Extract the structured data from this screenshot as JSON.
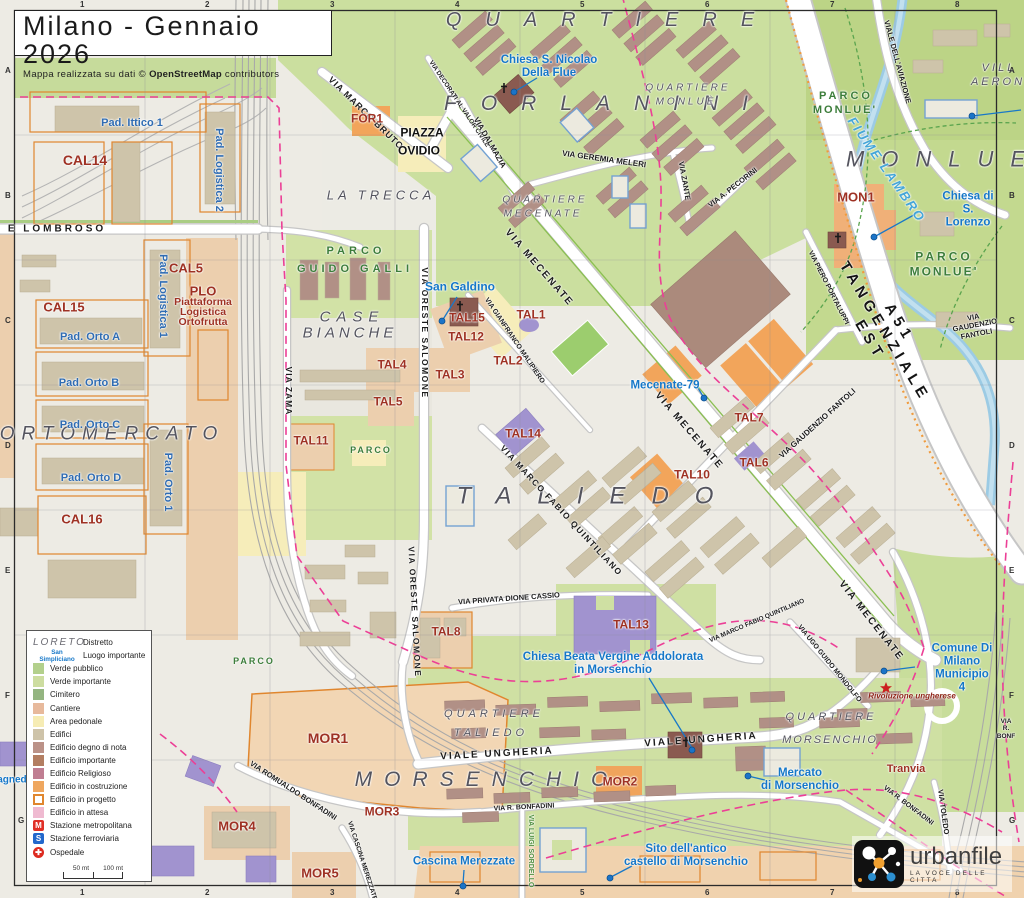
{
  "title": {
    "main": "Milano - Gennaio 2026",
    "sub_pre": "Mappa realizzata su dati © ",
    "sub_bold": "OpenStreetMap",
    "sub_post": " contributors"
  },
  "branding": {
    "name": "urbanfile",
    "tagline": "LA VOCE DELLE CITTA"
  },
  "grid": {
    "cols": [
      "1",
      "2",
      "3",
      "4",
      "5",
      "6",
      "7",
      "8"
    ],
    "rows": [
      "A",
      "B",
      "C",
      "D",
      "E",
      "F",
      "G"
    ]
  },
  "legend": {
    "rows": [
      {
        "type": "sample-district",
        "sample": "LORETO",
        "label": "Distretto"
      },
      {
        "type": "sample-place",
        "sample": "San Simpliciano",
        "label": "Luogo importante"
      },
      {
        "type": "fill",
        "color": "#b3d08c",
        "label": "Verde pubblico"
      },
      {
        "type": "fill",
        "color": "#cddda0",
        "label": "Verde importante"
      },
      {
        "type": "fill",
        "color": "#94b581",
        "label": "Cimitero"
      },
      {
        "type": "fill",
        "color": "#e7b99c",
        "label": "Cantiere"
      },
      {
        "type": "fill",
        "color": "#f6ecb4",
        "label": "Area pedonale"
      },
      {
        "type": "fill",
        "color": "#cec3a9",
        "label": "Edifici"
      },
      {
        "type": "fill",
        "color": "#bb9288",
        "label": "Edificio degno di nota"
      },
      {
        "type": "fill",
        "color": "#b37e62",
        "label": "Edificio importante"
      },
      {
        "type": "fill",
        "color": "#c07e92",
        "label": "Edificio Religioso"
      },
      {
        "type": "fill",
        "color": "#efa75f",
        "label": "Edificio in costruzione"
      },
      {
        "type": "outline",
        "color": "#e0862e",
        "label": "Edificio in progetto"
      },
      {
        "type": "fill",
        "color": "#efbad1",
        "label": "Edificio in attesa"
      },
      {
        "type": "badge",
        "symbol": "M",
        "bg": "#e02f26",
        "label": "Stazione metropolitana"
      },
      {
        "type": "badge",
        "symbol": "S",
        "bg": "#2268cc",
        "label": "Stazione ferroviaria"
      },
      {
        "type": "hospital",
        "symbol": "✚",
        "bg": "#dd2b20",
        "label": "Ospedale"
      }
    ],
    "scale": {
      "half": "50 mt",
      "full": "100 mt"
    }
  },
  "map_labels": [
    {
      "t": "QUARTIERE",
      "x": 612,
      "y": 20,
      "c": "dist",
      "s": 20,
      "ls": 24
    },
    {
      "t": "FORLANINI",
      "x": 608,
      "y": 104,
      "c": "dist",
      "s": 21,
      "ls": 24
    },
    {
      "t": "MONLUE",
      "x": 944,
      "y": 160,
      "c": "dist",
      "s": 22,
      "ls": 17
    },
    {
      "t": "ORTOMERCATO",
      "x": 112,
      "y": 434,
      "c": "dist",
      "s": 19,
      "ls": 7
    },
    {
      "t": "CASE",
      "x": 352,
      "y": 318,
      "c": "dist",
      "s": 15,
      "ls": 6
    },
    {
      "t": "BIANCHE",
      "x": 350,
      "y": 334,
      "c": "dist",
      "s": 15,
      "ls": 4
    },
    {
      "t": "TALIEDO",
      "x": 598,
      "y": 497,
      "c": "dist",
      "s": 24,
      "ls": 26
    },
    {
      "t": "MORSENCHIO",
      "x": 487,
      "y": 780,
      "c": "dist",
      "s": 21,
      "ls": 12
    },
    {
      "t": "LA TRECCA",
      "x": 381,
      "y": 196,
      "c": "dist",
      "s": 13,
      "ls": 4
    },
    {
      "t": "QUARTIERE",
      "x": 545,
      "y": 200,
      "c": "dist",
      "s": 10,
      "ls": 3
    },
    {
      "t": "MECENATE",
      "x": 543,
      "y": 214,
      "c": "dist",
      "s": 10,
      "ls": 3
    },
    {
      "t": "QUARTIERE",
      "x": 688,
      "y": 88,
      "c": "dist",
      "s": 10,
      "ls": 3
    },
    {
      "t": "MONLUÈ",
      "x": 686,
      "y": 102,
      "c": "dist",
      "s": 10,
      "ls": 3
    },
    {
      "t": "QUARTIERE",
      "x": 494,
      "y": 714,
      "c": "dist",
      "s": 11,
      "ls": 4
    },
    {
      "t": "TALIEDO",
      "x": 491,
      "y": 733,
      "c": "dist",
      "s": 11,
      "ls": 4
    },
    {
      "t": "QUARTIERE",
      "x": 831,
      "y": 717,
      "c": "dist",
      "s": 11,
      "ls": 3
    },
    {
      "t": "MORSENCHIO",
      "x": 830,
      "y": 740,
      "c": "dist",
      "s": 11,
      "ls": 2
    },
    {
      "t": "VILL",
      "x": 999,
      "y": 68,
      "c": "dist",
      "s": 11,
      "ls": 3
    },
    {
      "t": "AERON",
      "x": 998,
      "y": 82,
      "c": "dist",
      "s": 11,
      "ls": 3
    },
    {
      "t": "PARCO",
      "x": 356,
      "y": 251,
      "c": "park",
      "s": 11,
      "ls": 4
    },
    {
      "t": "GUIDO GALLI",
      "x": 355,
      "y": 269,
      "c": "park",
      "s": 11,
      "ls": 4
    },
    {
      "t": "PARCO",
      "x": 846,
      "y": 96,
      "c": "park",
      "s": 11,
      "ls": 3
    },
    {
      "t": "MONLUE'",
      "x": 845,
      "y": 110,
      "c": "park",
      "s": 11,
      "ls": 2
    },
    {
      "t": "PARCO",
      "x": 944,
      "y": 257,
      "c": "park",
      "s": 12,
      "ls": 3
    },
    {
      "t": "MONLUE'",
      "x": 944,
      "y": 272,
      "c": "park",
      "s": 12,
      "ls": 2
    },
    {
      "t": "PARCO",
      "x": 371,
      "y": 450,
      "c": "park",
      "s": 9,
      "ls": 2
    },
    {
      "t": "PARCO",
      "x": 254,
      "y": 661,
      "c": "park",
      "s": 9,
      "ls": 2
    },
    {
      "t": "FIUME LAMBRO",
      "x": 886,
      "y": 170,
      "r": 55,
      "c": "river",
      "s": 13,
      "ls": 2
    },
    {
      "t": "A51  TANGENZIALE  EST",
      "x": 884,
      "y": 332,
      "r": 59,
      "c": "hwy",
      "s": 15,
      "ls": 5
    },
    {
      "t": "VIA MARCO BRUTO",
      "x": 366,
      "y": 113,
      "r": 44,
      "c": "street",
      "s": 9,
      "ls": 1
    },
    {
      "t": "VIA DECORATI AL VALOR CIVILE",
      "x": 459,
      "y": 104,
      "r": 56,
      "c": "street",
      "s": 6.5
    },
    {
      "t": "VIA DALMAZIA",
      "x": 489,
      "y": 143,
      "r": 60,
      "c": "street",
      "s": 8
    },
    {
      "t": "VIA GEREMIA MELERI",
      "x": 604,
      "y": 160,
      "r": 8,
      "c": "street",
      "s": 8
    },
    {
      "t": "VIA ZANTE",
      "x": 684,
      "y": 181,
      "r": 80,
      "c": "street",
      "s": 7.5
    },
    {
      "t": "VIA A. PECORINI",
      "x": 733,
      "y": 188,
      "r": -38,
      "c": "street",
      "s": 7.5
    },
    {
      "t": "VIALE DELL'AVIAZIONE",
      "x": 897,
      "y": 62,
      "r": 75,
      "c": "street",
      "s": 7.5
    },
    {
      "t": "VIA  MECENATE",
      "x": 539,
      "y": 268,
      "r": 49,
      "c": "street",
      "s": 10,
      "ls": 2
    },
    {
      "t": "VIA  MECENATE",
      "x": 689,
      "y": 431,
      "r": 49,
      "c": "street",
      "s": 10,
      "ls": 2
    },
    {
      "t": "VIA  MECENATE",
      "x": 871,
      "y": 621,
      "r": 52,
      "c": "street",
      "s": 10,
      "ls": 2
    },
    {
      "t": "VIA ORESTE SALOMONE",
      "x": 424,
      "y": 333,
      "r": 90,
      "c": "street",
      "s": 8.5,
      "ls": 1.5
    },
    {
      "t": "VIA ORESTE SALOMONE",
      "x": 414,
      "y": 612,
      "r": 87,
      "c": "street",
      "s": 8.5,
      "ls": 1.5
    },
    {
      "t": "VIA ZAMA",
      "x": 288,
      "y": 391,
      "r": 90,
      "c": "street",
      "s": 8.5,
      "ls": 1
    },
    {
      "t": "VIA GIANFRANCO MALIPIERO",
      "x": 514,
      "y": 341,
      "r": 56,
      "c": "street",
      "s": 7
    },
    {
      "t": "VIA MARCO FABIO QUINTILIANO",
      "x": 561,
      "y": 511,
      "r": 47,
      "c": "street",
      "s": 8.5,
      "ls": 1.5
    },
    {
      "t": "VIA MARCO FABIO QUINTILIANO",
      "x": 757,
      "y": 621,
      "r": -23,
      "c": "street",
      "s": 6.5
    },
    {
      "t": "VIA PRIVATA DIONE CASSIO",
      "x": 509,
      "y": 599,
      "r": -4,
      "c": "street",
      "s": 7.5
    },
    {
      "t": "VIA GAUDENZIO FANTOLI",
      "x": 818,
      "y": 424,
      "r": -42,
      "c": "street",
      "s": 8
    },
    {
      "t": "VIA GAUDENZIO FANTOLI",
      "x": 975,
      "y": 326,
      "r": -11,
      "c": "street",
      "s": 7.5
    },
    {
      "t": "VIA PIERO PORTALUPPI",
      "x": 828,
      "y": 288,
      "r": 63,
      "c": "street",
      "s": 7
    },
    {
      "t": "VIA UGO GUIDO MONDOLFO",
      "x": 829,
      "y": 664,
      "r": 51,
      "c": "street",
      "s": 7
    },
    {
      "t": "E  LOMBROSO",
      "x": 57,
      "y": 229,
      "c": "street",
      "s": 10,
      "ls": 3
    },
    {
      "t": "VIALE  UNGHERIA",
      "x": 497,
      "y": 754,
      "r": -3,
      "c": "street",
      "s": 10,
      "ls": 2
    },
    {
      "t": "VIALE  UNGHERIA",
      "x": 701,
      "y": 740,
      "r": -4,
      "c": "street",
      "s": 10,
      "ls": 2
    },
    {
      "t": "VIA ROMUALDO BONFADINI",
      "x": 293,
      "y": 791,
      "r": 33,
      "c": "street",
      "s": 7.5
    },
    {
      "t": "VIA R. BONFADINI",
      "x": 524,
      "y": 808,
      "r": -3,
      "c": "street",
      "s": 7
    },
    {
      "t": "VIA R. BONFADINI",
      "x": 908,
      "y": 806,
      "r": 37,
      "c": "street",
      "s": 7
    },
    {
      "t": "VIA R. BONF",
      "x": 1006,
      "y": 729,
      "c": "street",
      "s": 6.5
    },
    {
      "t": "VIA TOLEDO",
      "x": 943,
      "y": 812,
      "r": 82,
      "c": "street",
      "s": 7.5
    },
    {
      "t": "VIA CASCINA MEREZZATE",
      "x": 362,
      "y": 861,
      "r": 72,
      "c": "street",
      "s": 6.5
    },
    {
      "t": "VIA LUIGI SORDELLO",
      "x": 530,
      "y": 851,
      "r": 90,
      "c": "streetg",
      "s": 7
    },
    {
      "t": "PIAZZA",
      "x": 422,
      "y": 133,
      "c": "plaza",
      "s": 12
    },
    {
      "t": "OVIDIO",
      "x": 419,
      "y": 151,
      "c": "plaza",
      "s": 12
    },
    {
      "t": "FOR1",
      "x": 367,
      "y": 119,
      "c": "code",
      "s": 12
    },
    {
      "t": "MON1",
      "x": 856,
      "y": 198,
      "c": "code",
      "s": 13
    },
    {
      "t": "CAL14",
      "x": 85,
      "y": 161,
      "c": "code",
      "s": 14
    },
    {
      "t": "CAL15",
      "x": 64,
      "y": 308,
      "c": "code",
      "s": 13
    },
    {
      "t": "CAL5",
      "x": 186,
      "y": 269,
      "c": "code",
      "s": 13
    },
    {
      "t": "CAL16",
      "x": 82,
      "y": 520,
      "c": "code",
      "s": 13
    },
    {
      "t": "PLO",
      "x": 203,
      "y": 292,
      "c": "code",
      "s": 13
    },
    {
      "t": "Piattaforma",
      "x": 203,
      "y": 303,
      "c": "code",
      "s": 10.5
    },
    {
      "t": "Logistica",
      "x": 203,
      "y": 313,
      "c": "code",
      "s": 10.5
    },
    {
      "t": "Ortofrutta",
      "x": 203,
      "y": 323,
      "c": "code",
      "s": 10.5
    },
    {
      "t": "TAL15",
      "x": 467,
      "y": 318,
      "c": "code",
      "s": 12
    },
    {
      "t": "TAL12",
      "x": 466,
      "y": 337,
      "c": "code",
      "s": 12
    },
    {
      "t": "TAL1",
      "x": 531,
      "y": 315,
      "c": "code",
      "s": 12
    },
    {
      "t": "TAL2",
      "x": 508,
      "y": 361,
      "c": "code",
      "s": 12
    },
    {
      "t": "TAL3",
      "x": 450,
      "y": 375,
      "c": "code",
      "s": 12
    },
    {
      "t": "TAL4",
      "x": 392,
      "y": 365,
      "c": "code",
      "s": 12
    },
    {
      "t": "TAL5",
      "x": 388,
      "y": 402,
      "c": "code",
      "s": 12
    },
    {
      "t": "TAL11",
      "x": 311,
      "y": 441,
      "c": "code",
      "s": 12
    },
    {
      "t": "TAL14",
      "x": 523,
      "y": 434,
      "c": "code",
      "s": 12
    },
    {
      "t": "TAL7",
      "x": 749,
      "y": 418,
      "c": "code",
      "s": 12
    },
    {
      "t": "TAL6",
      "x": 754,
      "y": 463,
      "c": "code",
      "s": 12
    },
    {
      "t": "TAL10",
      "x": 692,
      "y": 475,
      "c": "code",
      "s": 12
    },
    {
      "t": "TAL8",
      "x": 446,
      "y": 632,
      "c": "code",
      "s": 12
    },
    {
      "t": "TAL13",
      "x": 631,
      "y": 625,
      "c": "code",
      "s": 12
    },
    {
      "t": "MOR1",
      "x": 328,
      "y": 739,
      "c": "code",
      "s": 14
    },
    {
      "t": "MOR2",
      "x": 620,
      "y": 782,
      "c": "code",
      "s": 12
    },
    {
      "t": "MOR3",
      "x": 382,
      "y": 812,
      "c": "code",
      "s": 12
    },
    {
      "t": "MOR4",
      "x": 237,
      "y": 827,
      "c": "code",
      "s": 13
    },
    {
      "t": "MOR5",
      "x": 320,
      "y": 874,
      "c": "code",
      "s": 13
    },
    {
      "t": "Tranvia",
      "x": 906,
      "y": 769,
      "c": "code",
      "s": 11
    },
    {
      "t": "Rivoluzione ungherese",
      "x": 912,
      "y": 697,
      "c": "rednote",
      "s": 8
    },
    {
      "t": "Pad. Ittico 1",
      "x": 132,
      "y": 123,
      "c": "pad",
      "s": 11
    },
    {
      "t": "Pad. Logistica 2",
      "x": 219,
      "y": 170,
      "r": 90,
      "c": "pad",
      "s": 11
    },
    {
      "t": "Pad. Logistica 1",
      "x": 163,
      "y": 296,
      "r": 90,
      "c": "pad",
      "s": 11
    },
    {
      "t": "Pad. Orto A",
      "x": 90,
      "y": 337,
      "c": "pad",
      "s": 11
    },
    {
      "t": "Pad. Orto B",
      "x": 89,
      "y": 383,
      "c": "pad",
      "s": 11
    },
    {
      "t": "Pad. Orto C",
      "x": 90,
      "y": 425,
      "c": "pad",
      "s": 11
    },
    {
      "t": "Pad. Orto D",
      "x": 91,
      "y": 478,
      "c": "pad",
      "s": 11
    },
    {
      "t": "Pad. Orto 1",
      "x": 168,
      "y": 482,
      "r": 90,
      "c": "pad",
      "s": 11
    },
    {
      "n": "poi-chiesa-s-nicolao",
      "t": "Chiesa S. Nicolao\nDella Flue",
      "x": 549,
      "y": 67,
      "c": "poi",
      "s": 11.5
    },
    {
      "n": "poi-san-galdino",
      "t": "San Galdino",
      "x": 460,
      "y": 287,
      "c": "poi",
      "s": 12
    },
    {
      "n": "poi-mecenate-79",
      "t": "Mecenate-79",
      "x": 665,
      "y": 386,
      "c": "poi",
      "s": 11.5
    },
    {
      "n": "poi-chiesa-s-lorenzo",
      "t": "Chiesa di S. Lorenzo",
      "x": 968,
      "y": 210,
      "c": "poi",
      "s": 11.5
    },
    {
      "n": "poi-chiesa-beata-vergine",
      "t": "Chiesa Beata Vergine Addolorata\nin Morsenchio",
      "x": 613,
      "y": 664,
      "c": "poi",
      "s": 11.5
    },
    {
      "n": "poi-municipio-4",
      "t": "Comune Di Milano\nMunicipio 4",
      "x": 962,
      "y": 668,
      "c": "poi",
      "s": 11.5
    },
    {
      "n": "poi-mercato-morsenchio",
      "t": "Mercato\ndi Morsenchio",
      "x": 800,
      "y": 780,
      "c": "poi",
      "s": 11.5
    },
    {
      "n": "poi-cascina-merezzate",
      "t": "Cascina Merezzate",
      "x": 464,
      "y": 862,
      "c": "poi",
      "s": 11.5
    },
    {
      "n": "poi-sito-castello",
      "t": "Sito dell'antico\ncastello di Morsenchio",
      "x": 686,
      "y": 856,
      "c": "poi",
      "s": 11.5
    },
    {
      "n": "poi-fragment",
      "t": "agnedo",
      "x": 15,
      "y": 780,
      "c": "poi",
      "s": 10
    }
  ]
}
